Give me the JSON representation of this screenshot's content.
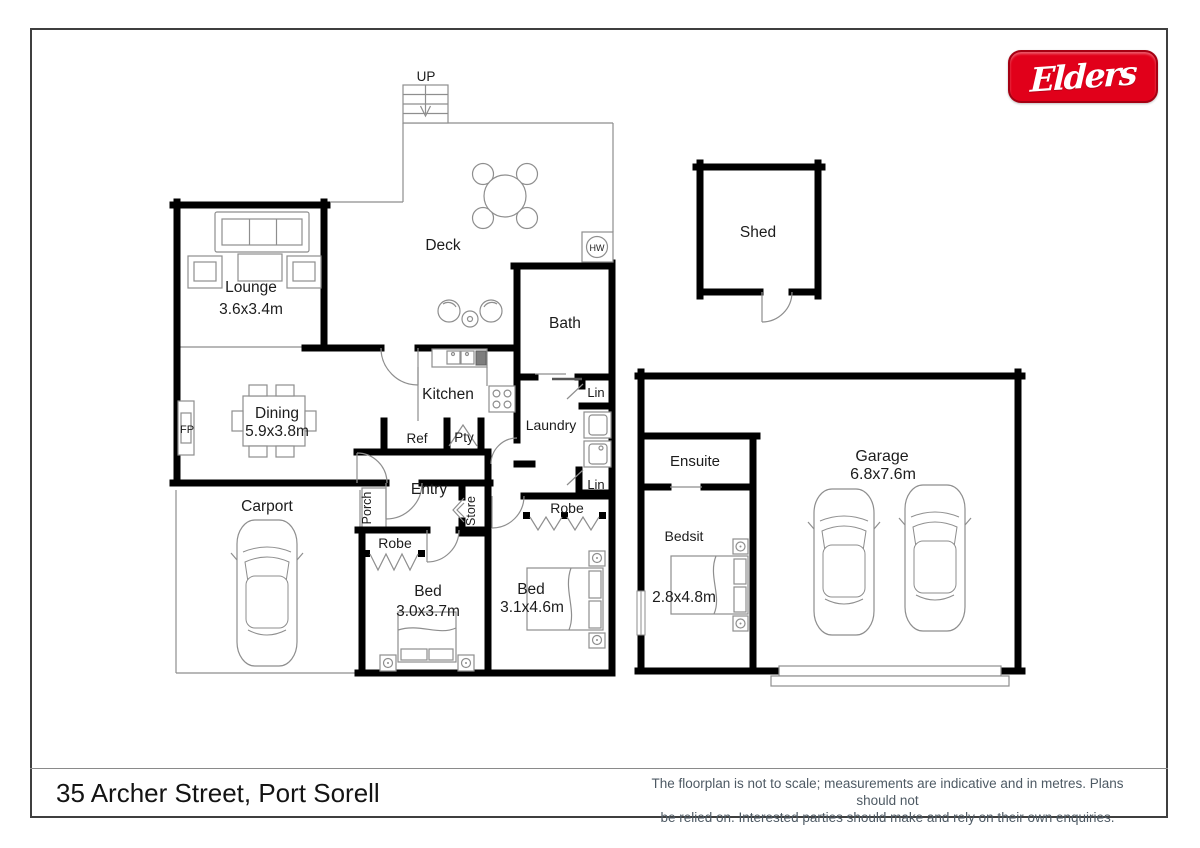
{
  "logo": {
    "text": "Elders",
    "bg": "#e1001a",
    "border": "#a50012",
    "text_color": "#ffffff"
  },
  "footer": {
    "address": "35 Archer Street, Port Sorell",
    "disclaimer1": "The floorplan is not to scale; measurements are indicative and in metres. Plans should not",
    "disclaimer2": "be relied on. Interested parties should make and rely on their own enquiries."
  },
  "labels": {
    "up": "UP",
    "deck": "Deck",
    "shed": "Shed",
    "hw": "HW",
    "lounge": "Lounge",
    "lounge_dim": "3.6x3.4m",
    "bath": "Bath",
    "kitchen": "Kitchen",
    "lin_bath": "Lin",
    "lin_hall": "Lin",
    "laundry": "Laundry",
    "dining": "Dining",
    "dining_dim": "5.9x3.8m",
    "fp": "FP",
    "ref": "Ref",
    "pty": "Pty",
    "ensuite": "Ensuite",
    "garage": "Garage",
    "garage_dim": "6.8x7.6m",
    "entry": "Entry",
    "carport": "Carport",
    "porch": "Porch",
    "store": "Store",
    "robe_front": "Robe",
    "robe_rear": "Robe",
    "bed_front": "Bed",
    "bed_front_dim": "3.0x3.7m",
    "bed_rear": "Bed",
    "bed_rear_dim": "3.1x4.6m",
    "bedsit": "Bedsit",
    "bedsit_dim": "2.8x4.8m"
  },
  "colors": {
    "wall": "#000000",
    "outline": "#8e8e8e",
    "label": "#1c1c1c",
    "logo_red": "#e1001a",
    "disclaimer_text": "#4e5a64"
  }
}
